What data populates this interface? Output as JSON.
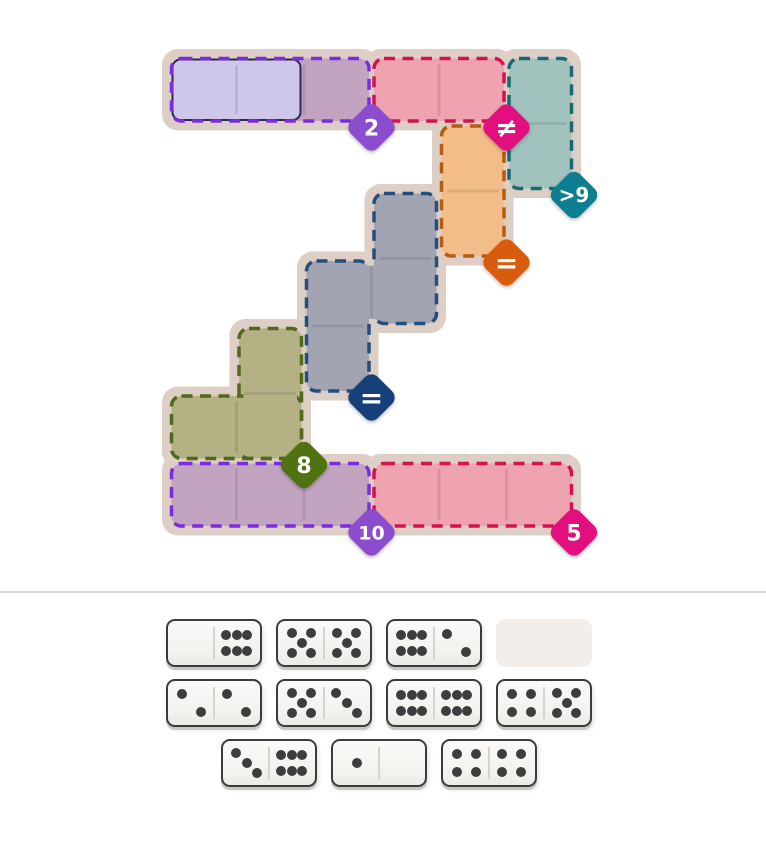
{
  "page": {
    "background": "#ffffff"
  },
  "board": {
    "grid": {
      "origin_x": 169,
      "origin_y": 56,
      "cell": 67.5,
      "width": 766,
      "height": 575
    },
    "halo_color": "#ddcfc5",
    "seam_color": "rgba(0,0,0,0.09)",
    "regions": [
      {
        "name": "violet-top",
        "fill": "#c2a3c0",
        "stroke": "#7b2ce0",
        "rects": [
          {
            "c": 0,
            "r": 0,
            "w": 3,
            "h": 1
          }
        ],
        "patches": [],
        "badge": {
          "label": "2",
          "color": "#8b4cce",
          "c": 3,
          "r": 1,
          "font_size": 22
        }
      },
      {
        "name": "crimson-top",
        "fill": "#efa2b0",
        "stroke": "#d31250",
        "rects": [
          {
            "c": 3,
            "r": 0,
            "w": 2,
            "h": 1
          }
        ],
        "patches": [],
        "badge": {
          "label": "≠",
          "color": "#e30f7e",
          "c": 5,
          "r": 1,
          "font_size": 27
        }
      },
      {
        "name": "teal",
        "fill": "#a2c2bd",
        "stroke": "#186a72",
        "rects": [
          {
            "c": 5,
            "r": 0,
            "w": 1,
            "h": 2
          }
        ],
        "patches": [],
        "badge": {
          "label": ">9",
          "color": "#0d7f90",
          "c": 6,
          "r": 2,
          "font_size": 20
        }
      },
      {
        "name": "orange",
        "fill": "#f2bd88",
        "stroke": "#b35d0e",
        "rects": [
          {
            "c": 4,
            "r": 1,
            "w": 1,
            "h": 2
          }
        ],
        "patches": [],
        "badge": {
          "label": "=",
          "color": "#d85c0e",
          "c": 5,
          "r": 3,
          "font_size": 28
        }
      },
      {
        "name": "slate",
        "fill": "#a3a4b2",
        "stroke": "#234f7d",
        "rects": [
          {
            "c": 3,
            "r": 2,
            "w": 1,
            "h": 2
          },
          {
            "c": 2,
            "r": 3,
            "w": 1,
            "h": 2
          }
        ],
        "patches": [
          {
            "o": "v",
            "c": 3,
            "r": 3
          }
        ],
        "badge": {
          "label": "=",
          "color": "#17407a",
          "c": 3,
          "r": 5,
          "font_size": 28
        }
      },
      {
        "name": "olive",
        "fill": "#b4b185",
        "stroke": "#50691a",
        "rects": [
          {
            "c": 1,
            "r": 4,
            "w": 1,
            "h": 2
          },
          {
            "c": 0,
            "r": 5,
            "w": 2,
            "h": 1
          }
        ],
        "patches": [
          {
            "o": "v",
            "c": 1,
            "r": 5
          },
          {
            "o": "h",
            "c": 1,
            "r": 5
          }
        ],
        "badge": {
          "label": "8",
          "color": "#4f7310",
          "c": 2,
          "r": 6,
          "font_size": 22
        }
      },
      {
        "name": "violet-bottom",
        "fill": "#c2a3c0",
        "stroke": "#7b2ce0",
        "rects": [
          {
            "c": 0,
            "r": 6,
            "w": 3,
            "h": 1
          }
        ],
        "patches": [],
        "badge": {
          "label": "10",
          "color": "#8b4cce",
          "c": 3,
          "r": 7,
          "font_size": 19
        }
      },
      {
        "name": "crimson-bottom",
        "fill": "#efa2b0",
        "stroke": "#d31250",
        "rects": [
          {
            "c": 3,
            "r": 6,
            "w": 3,
            "h": 1
          }
        ],
        "patches": [],
        "badge": {
          "label": "5",
          "color": "#e30f7e",
          "c": 6,
          "r": 7,
          "font_size": 22
        }
      }
    ],
    "placed_dominoes": [
      {
        "cells": [
          [
            0,
            0
          ],
          [
            1,
            0
          ]
        ],
        "pips": [
          0,
          0
        ],
        "fill": "#cfc7e9",
        "border": "#2e2a4f",
        "divider": "#b2a6d4"
      }
    ]
  },
  "divider": {
    "y": 591,
    "color": "#dcdcdc"
  },
  "tray": {
    "pip_color": "#3d3d3d",
    "empty_slot_fill": "#f4eeea",
    "pip_layouts": {
      "0": [],
      "1": [
        [
          50,
          50
        ]
      ],
      "2": [
        [
          28,
          28
        ],
        [
          72,
          72
        ]
      ],
      "3": [
        [
          26,
          26
        ],
        [
          50,
          50
        ],
        [
          74,
          74
        ]
      ],
      "4": [
        [
          29,
          28
        ],
        [
          71,
          28
        ],
        [
          29,
          72
        ],
        [
          71,
          72
        ]
      ],
      "5": [
        [
          27,
          26
        ],
        [
          73,
          26
        ],
        [
          50,
          50
        ],
        [
          27,
          74
        ],
        [
          73,
          74
        ]
      ],
      "6": [
        [
          25,
          30
        ],
        [
          50,
          30
        ],
        [
          75,
          30
        ],
        [
          25,
          70
        ],
        [
          50,
          70
        ],
        [
          75,
          70
        ]
      ]
    },
    "rows": [
      {
        "y": 619,
        "items": [
          {
            "type": "domino",
            "pips": [
              0,
              6
            ],
            "x": 166
          },
          {
            "type": "domino",
            "pips": [
              5,
              5
            ],
            "x": 276
          },
          {
            "type": "domino",
            "pips": [
              6,
              2
            ],
            "x": 386
          },
          {
            "type": "empty",
            "x": 496
          }
        ]
      },
      {
        "y": 679,
        "items": [
          {
            "type": "domino",
            "pips": [
              2,
              2
            ],
            "x": 166
          },
          {
            "type": "domino",
            "pips": [
              5,
              3
            ],
            "x": 276
          },
          {
            "type": "domino",
            "pips": [
              6,
              6
            ],
            "x": 386
          },
          {
            "type": "domino",
            "pips": [
              4,
              5
            ],
            "x": 496
          }
        ]
      },
      {
        "y": 739,
        "items": [
          {
            "type": "domino",
            "pips": [
              3,
              6
            ],
            "x": 221
          },
          {
            "type": "domino",
            "pips": [
              1,
              0
            ],
            "x": 331
          },
          {
            "type": "domino",
            "pips": [
              4,
              4
            ],
            "x": 441
          }
        ]
      }
    ]
  }
}
